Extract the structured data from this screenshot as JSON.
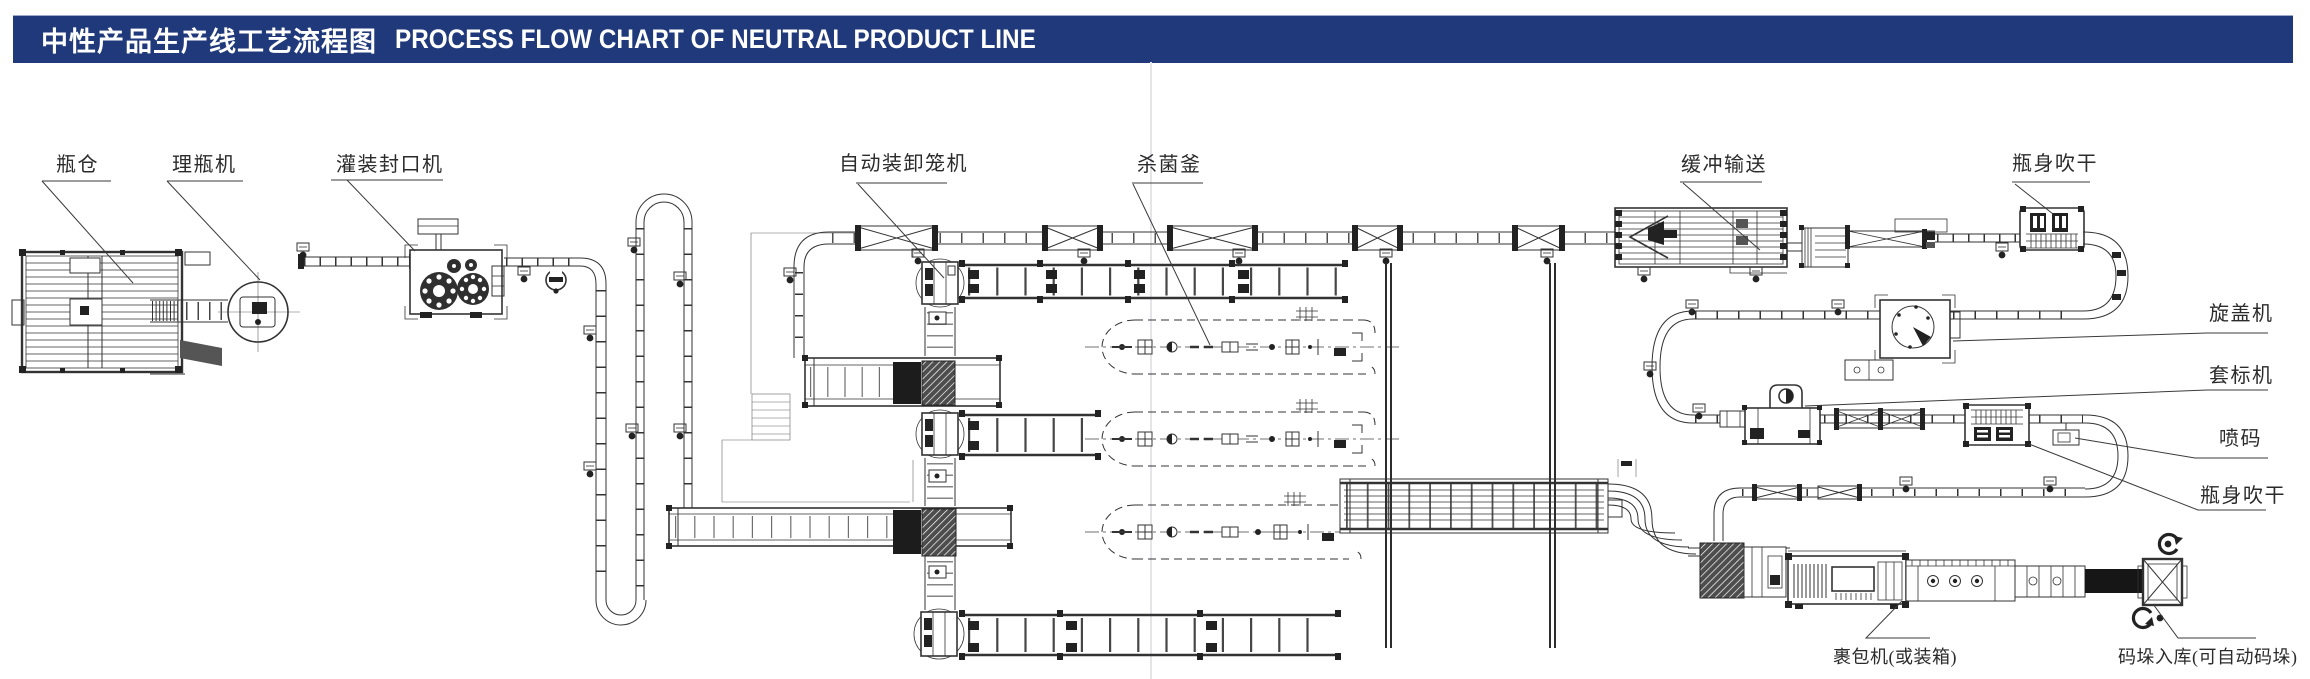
{
  "title": {
    "zh": "中性产品生产线工艺流程图",
    "en": "PROCESS FLOW CHART OF NEUTRAL PRODUCT LINE"
  },
  "colors": {
    "header_bg": "#20397b",
    "header_text": "#ffffff",
    "drawing_line": "#333333",
    "label_text": "#2b2b2b"
  },
  "labels": [
    {
      "id": "bottle-silo",
      "text": "瓶仓"
    },
    {
      "id": "bottle-unscrambler",
      "text": "理瓶机"
    },
    {
      "id": "filling-capping-machine",
      "text": "灌装封口机"
    },
    {
      "id": "auto-cage-loader",
      "text": "自动装卸笼机"
    },
    {
      "id": "sterilization-kettle",
      "text": "杀菌釜"
    },
    {
      "id": "buffer-conveyor",
      "text": "缓冲输送"
    },
    {
      "id": "bottle-drying-top",
      "text": "瓶身吹干"
    },
    {
      "id": "capping-machine",
      "text": "旋盖机"
    },
    {
      "id": "sleeve-labeler",
      "text": "套标机"
    },
    {
      "id": "inkjet-coder",
      "text": "喷码"
    },
    {
      "id": "bottle-drying-right",
      "text": "瓶身吹干"
    },
    {
      "id": "wrapping-machine",
      "text": "裹包机(或装箱)"
    },
    {
      "id": "palletizing",
      "text": "码垛入库(可自动码垛)"
    }
  ]
}
